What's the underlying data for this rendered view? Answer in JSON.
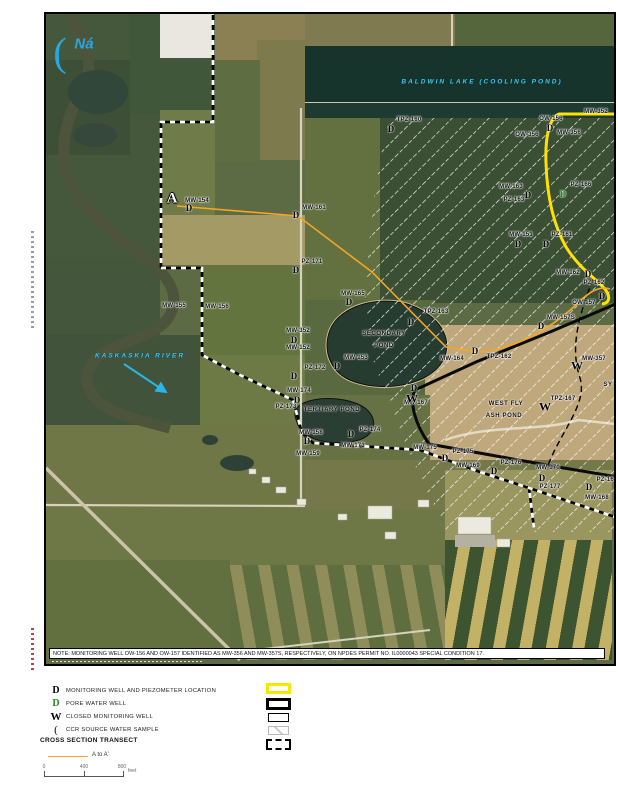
{
  "colors": {
    "yellow_line": "#ffe000",
    "orange_line": "#f5a623",
    "cyan": "#3ec9ef",
    "pore_green": "#1e8b1e"
  },
  "note": {
    "text": "NOTE: MONITORING WELL OW-156 AND OW-157 IDENTIFIED AS MW-356 AND MW-357S, RESPECTIVELY, ON NPDES PERMIT NO. IL0000043 SPECIAL CONDITION 17."
  },
  "map": {
    "section_marker": {
      "text": "A",
      "x": 172,
      "y": 199
    },
    "source_sample": {
      "glyph": "(",
      "label": "Ná",
      "gx": 60,
      "gy": 52,
      "lx": 84,
      "ly": 44
    },
    "water_labels": [
      {
        "text": "BALDWIN   LAKE   (COOLING   POND)",
        "x": 482,
        "y": 82
      },
      {
        "text": "KASKASKIA   RIVER",
        "x": 140,
        "y": 356
      }
    ],
    "area_labels": [
      {
        "text": "SECONDARY",
        "x": 384,
        "y": 334
      },
      {
        "text": "POND",
        "x": 384,
        "y": 346
      },
      {
        "text": "TERTIARY POND",
        "x": 332,
        "y": 410
      },
      {
        "text": "WEST   FLY",
        "x": 506,
        "y": 404
      },
      {
        "text": "ASH   POND",
        "x": 504,
        "y": 416
      },
      {
        "text": "SY",
        "x": 608,
        "y": 385
      }
    ],
    "wells": [
      {
        "label": "MW-154",
        "x": 197,
        "y": 201,
        "marker": "D",
        "mx": 189,
        "my": 208
      },
      {
        "label": "MW-161",
        "x": 314,
        "y": 208,
        "marker": "D",
        "mx": 296,
        "my": 215
      },
      {
        "label": "PZ-171",
        "x": 312,
        "y": 262,
        "marker": "D",
        "mx": 296,
        "my": 270
      },
      {
        "label": "MW-155",
        "x": 174,
        "y": 306
      },
      {
        "label": "MW-156",
        "x": 217,
        "y": 307
      },
      {
        "label": "MW-165",
        "x": 353,
        "y": 294,
        "marker": "D",
        "mx": 349,
        "my": 302
      },
      {
        "label": "MW-352",
        "x": 298,
        "y": 331,
        "marker": "D",
        "mx": 294,
        "my": 340
      },
      {
        "label": "MW-152",
        "x": 298,
        "y": 348
      },
      {
        "label": "PZ-172",
        "x": 315,
        "y": 368,
        "marker": "D",
        "mx": 294,
        "my": 376
      },
      {
        "label": "MW-153",
        "x": 356,
        "y": 358,
        "marker": "D",
        "mx": 337,
        "my": 366
      },
      {
        "label": "TPZ-163",
        "x": 436,
        "y": 312,
        "marker": "D",
        "mx": 411,
        "my": 322
      },
      {
        "label": "MW-174",
        "x": 299,
        "y": 391,
        "marker": "D",
        "mx": 297,
        "my": 400
      },
      {
        "label": "PZ-173",
        "x": 286,
        "y": 407
      },
      {
        "label": "TPZ-160",
        "x": 409,
        "y": 120,
        "marker": "D",
        "mx": 391,
        "my": 129
      },
      {
        "label": "OW-156",
        "x": 551,
        "y": 119,
        "marker": "D",
        "mx": 550,
        "my": 128
      },
      {
        "label": "OW-356",
        "x": 527,
        "y": 135
      },
      {
        "label": "MW-356",
        "x": 569,
        "y": 133
      },
      {
        "label": "MW-352",
        "x": 596,
        "y": 112
      },
      {
        "label": "MW-163",
        "x": 511,
        "y": 187,
        "marker": "D",
        "mx": 528,
        "my": 195
      },
      {
        "label": "PZ-163",
        "x": 514,
        "y": 200
      },
      {
        "label": "PZ-166",
        "x": 581,
        "y": 185,
        "marker": "Dg",
        "mx": 563,
        "my": 194
      },
      {
        "label": "MW-151",
        "x": 521,
        "y": 235,
        "marker": "D",
        "mx": 518,
        "my": 244
      },
      {
        "label": "PZ-161",
        "x": 562,
        "y": 235,
        "marker": "D",
        "mx": 546,
        "my": 244
      },
      {
        "label": "MW-162",
        "x": 568,
        "y": 273,
        "marker": "D",
        "mx": 588,
        "my": 274
      },
      {
        "label": "PZ-162",
        "x": 594,
        "y": 283
      },
      {
        "label": "OW-157",
        "x": 584,
        "y": 303,
        "marker": "D",
        "mx": 602,
        "my": 296
      },
      {
        "label": "MW-157S",
        "x": 561,
        "y": 318,
        "marker": "D",
        "mx": 541,
        "my": 326
      },
      {
        "label": "MW-357",
        "x": 594,
        "y": 359,
        "marker": "W",
        "mx": 577,
        "my": 366
      },
      {
        "label": "MW-164",
        "x": 452,
        "y": 359
      },
      {
        "label": "TPZ-162",
        "x": 499,
        "y": 357,
        "marker": "D",
        "mx": 475,
        "my": 351
      },
      {
        "label": "TPZ-167",
        "x": 563,
        "y": 399,
        "marker": "W",
        "mx": 545,
        "my": 407
      },
      {
        "label": "PZ-175",
        "x": 463,
        "y": 452,
        "marker": "D",
        "mx": 445,
        "my": 458
      },
      {
        "label": "MW-169",
        "x": 468,
        "y": 466
      },
      {
        "label": "PZ-176",
        "x": 511,
        "y": 463,
        "marker": "D",
        "mx": 494,
        "my": 471
      },
      {
        "label": "MW-170",
        "x": 548,
        "y": 468,
        "marker": "D",
        "mx": 542,
        "my": 478
      },
      {
        "label": "PZ-177",
        "x": 550,
        "y": 487
      },
      {
        "label": "MW-168",
        "x": 597,
        "y": 498,
        "marker": "D",
        "mx": 589,
        "my": 487
      },
      {
        "label": "PZ-164",
        "x": 607,
        "y": 480
      },
      {
        "label": "MW-158",
        "x": 311,
        "y": 433,
        "marker": "D",
        "mx": 307,
        "my": 441
      },
      {
        "label": "MW-159",
        "x": 308,
        "y": 454
      },
      {
        "label": "PZ-174",
        "x": 370,
        "y": 430,
        "marker": "D",
        "mx": 351,
        "my": 434
      },
      {
        "label": "MW-173",
        "x": 353,
        "y": 446
      },
      {
        "label": "MW-175",
        "x": 425,
        "y": 448
      },
      {
        "label": "MW-167",
        "x": 416,
        "y": 403
      },
      {
        "marker": "D",
        "mx": 414,
        "my": 388
      },
      {
        "marker": "W",
        "mx": 412,
        "my": 399
      }
    ]
  },
  "legend": {
    "items": [
      {
        "glyph": "D",
        "style": "g-d-black",
        "label": "MONITORING WELL AND PIEZOMETER LOCATION"
      },
      {
        "glyph": "D",
        "style": "g-d-green",
        "label": "PORE WATER WELL"
      },
      {
        "glyph": "W",
        "style": "g-w",
        "label": "CLOSED MONITORING WELL"
      },
      {
        "glyph": "(",
        "style": "g-paren",
        "label": "CCR SOURCE WATER SAMPLE"
      }
    ],
    "section_header": "CROSS SECTION TRANSECT",
    "transect_label": "A to A'",
    "scale": {
      "ticks": [
        "0",
        "400",
        "800"
      ],
      "tick_x": [
        44,
        84,
        122
      ],
      "unit": "feet"
    }
  }
}
